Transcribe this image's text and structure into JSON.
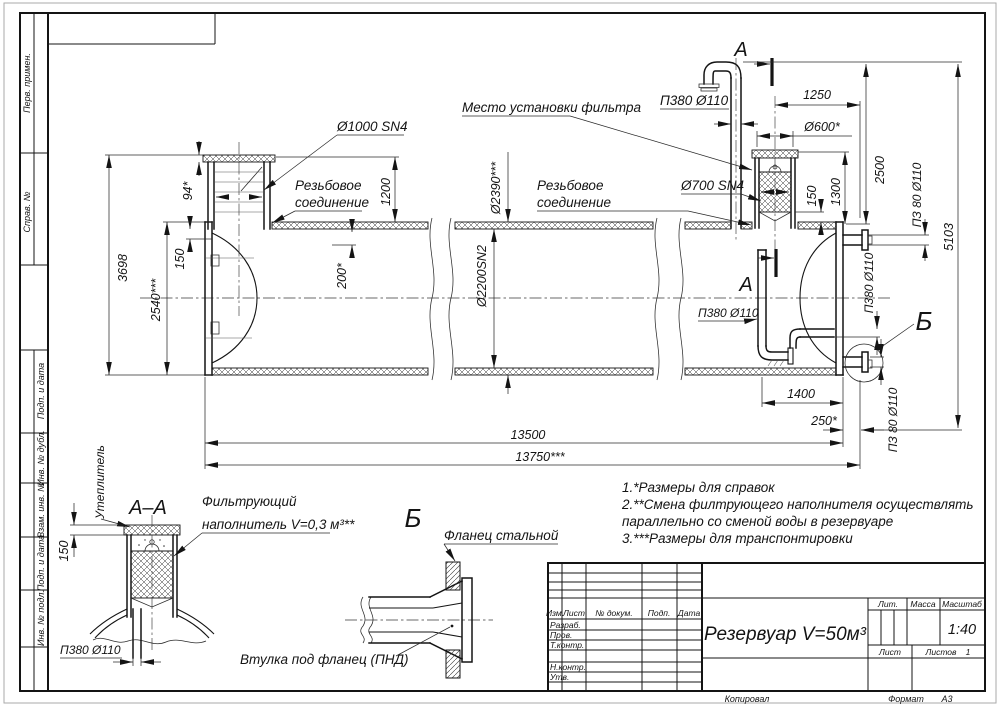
{
  "margin": {
    "labels": [
      "Перв. примен.",
      "Справ. №",
      "Подп. и дата",
      "Инв. № дубл.",
      "Взам. инв. №",
      "Подп. и дата",
      "Инв. № подл."
    ]
  },
  "main": {
    "label_d1000": "Ø1000 SN4",
    "label_filter_place": "Место установки фильтра",
    "thread_line1": "Резьбовое",
    "thread_line2": "соединение",
    "label_d700": "Ø700 SN4",
    "label_p380_vent": "П380 Ø110",
    "label_p380_inner": "П380 Ø110",
    "label_p380_right": "П380 Ø110",
    "label_pz80_top": "ПЗ 80 Ø110",
    "label_pz80_bottom": "ПЗ 80 Ø110",
    "section_letter": "А",
    "detail_letter": "Б",
    "dims": {
      "d94": "94*",
      "d150_left": "150",
      "d3698": "3698",
      "d2540": "2540***",
      "d1200": "1200",
      "d200": "200*",
      "d2390": "Ø2390***",
      "d2200": "Ø2200SN2",
      "d1250": "1250",
      "d600": "Ø600*",
      "d2500": "2500",
      "d150_filter": "150",
      "d1300": "1300",
      "d5103": "5103",
      "d1400": "1400",
      "d250": "250*",
      "d13500": "13500",
      "d13750": "13750***"
    }
  },
  "section_aa": {
    "title": "А–А",
    "label_insulation": "Утеплитель",
    "filter_line1": "Фильтрующий",
    "filter_line2": "наполнитель V=0,3 м³**",
    "dim150": "150",
    "label_p380": "П380 Ø110"
  },
  "detail_b": {
    "title": "Б",
    "label_flange": "Фланец стальной",
    "label_sleeve": "Втулка под фланец (ПНД)"
  },
  "notes": {
    "line1": "1.*Размеры для справок",
    "line2": "2.**Смена филтрующего наполнителя осуществлять",
    "line3": "параллельно со сменой воды в резервуаре",
    "line4": "3.***Размеры для транспонтировки"
  },
  "title_block": {
    "col_izm": "Изм.",
    "col_list": "Лист",
    "col_doc": "№ докум.",
    "col_podp": "Подп.",
    "col_data": "Дата",
    "row_razrab": "Разраб.",
    "row_prov": "Пров.",
    "row_tkontr": "Т.контр.",
    "row_nkontr": "Н.контр.",
    "row_utv": "Утв.",
    "doc_title": "Резервуар V=50м³",
    "lit": "Лит.",
    "massa": "Масса",
    "masshtab": "Масштаб",
    "scale": "1:40",
    "list": "Лист",
    "listov": "Листов",
    "listov_value": "1"
  },
  "footer": {
    "kopiroval": "Копировал",
    "format_label": "Формат",
    "format_value": "А3"
  }
}
